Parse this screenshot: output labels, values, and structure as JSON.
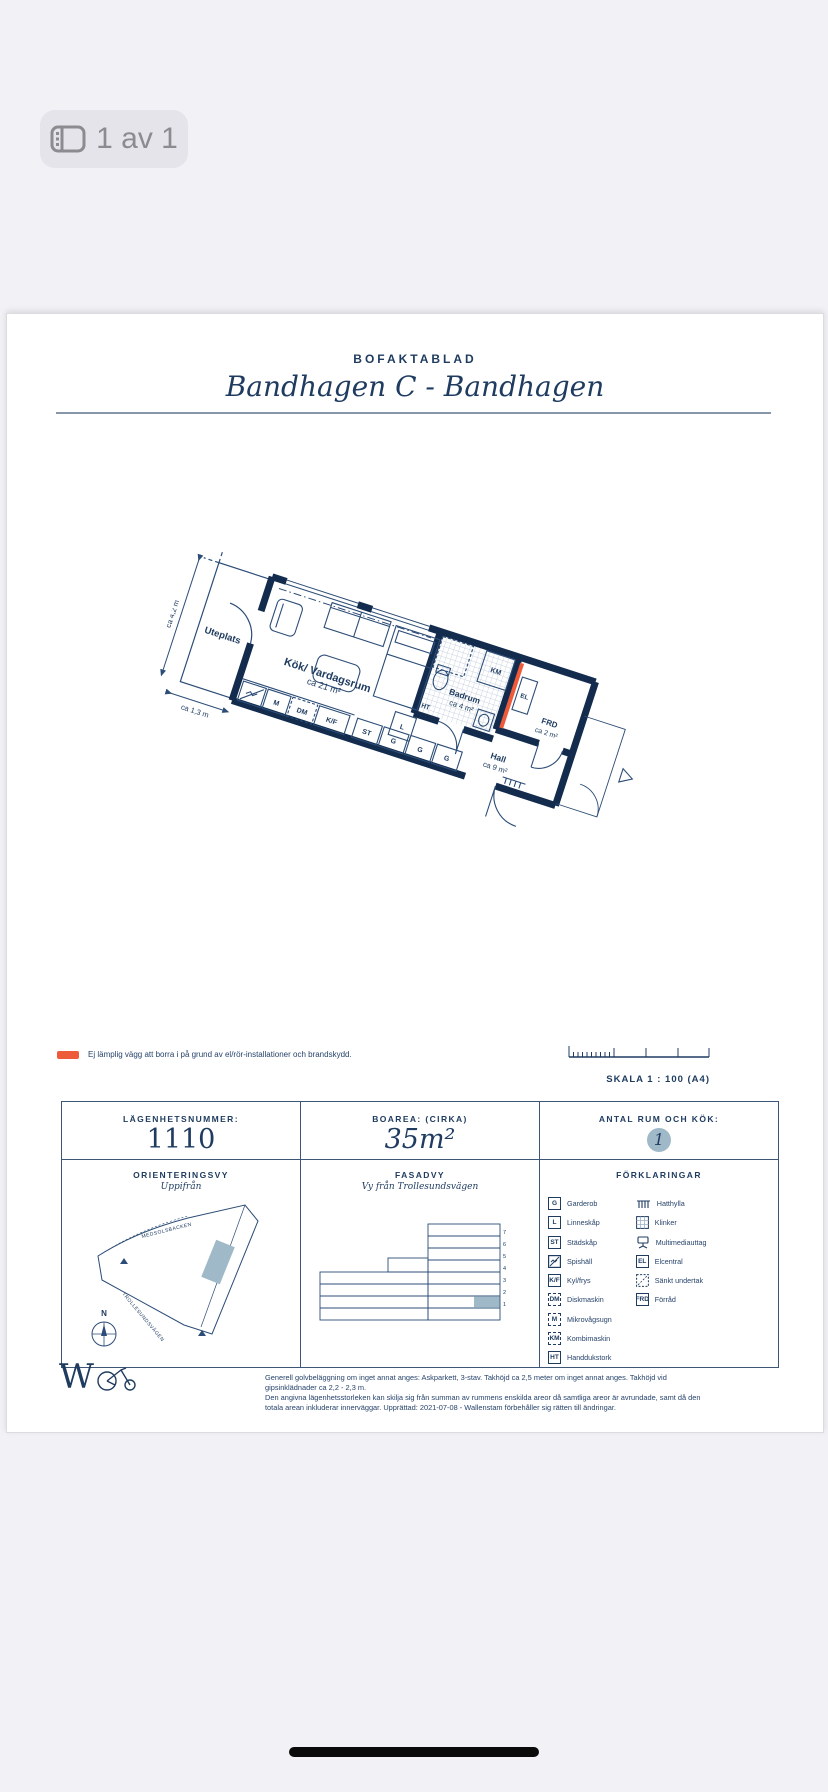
{
  "viewer": {
    "page_indicator": "1 av 1"
  },
  "header": {
    "eyebrow": "BOFAKTABLAD",
    "title": "Bandhagen C - Bandhagen"
  },
  "plan": {
    "rooms": {
      "uteplats": "Uteplats",
      "livingroom": {
        "name": "Kök/ Vardagsrum",
        "area": "ca 21 m²"
      },
      "badrum": {
        "name": "Badrum",
        "area": "ca 4 m²"
      },
      "hall": {
        "name": "Hall",
        "area": "ca 9 m²"
      },
      "frd": {
        "name": "FRD",
        "area": "ca 2 m²"
      }
    },
    "dimensions": {
      "left": "ca 4,2 m",
      "bottom": "ca 1,3 m"
    },
    "fixtures": {
      "m": "M",
      "dm": "DM",
      "kf": "K/F",
      "st": "ST",
      "g1": "G",
      "g2": "G",
      "g3": "G",
      "l": "L",
      "ht": "HT",
      "km": "KM",
      "el": "EL"
    },
    "colors": {
      "wall": "#132c4e",
      "line": "#2c4d77",
      "warning": "#ee5b3a"
    }
  },
  "note": {
    "text": "Ej lämplig vägg att borra i på grund av el/rör-installationer och brandskydd."
  },
  "scale": {
    "label": "SKALA 1 : 100 (A4)"
  },
  "info": {
    "apartment": {
      "label": "LÄGENHETSNUMMER:",
      "value": "1110"
    },
    "area": {
      "label": "BOAREA: (CIRKA)",
      "value": "35m²"
    },
    "rooms": {
      "label": "ANTAL RUM OCH KÖK:",
      "value": "1"
    },
    "orientation": {
      "label": "ORIENTERINGSVY",
      "sub": "Uppifrån",
      "street_top": "MEDSOLSBACKEN",
      "street_bottom": "TROLLESUNDSVÄGEN",
      "compass": "N"
    },
    "facade": {
      "label": "FASADVY",
      "sub": "Vy från Trollesundsvägen",
      "floors": [
        "7",
        "6",
        "5",
        "4",
        "3",
        "2",
        "1"
      ]
    },
    "legend": {
      "label": "FÖRKLARINGAR",
      "left": [
        {
          "key": "G",
          "label": "Garderob"
        },
        {
          "key": "L",
          "label": "Linneskåp"
        },
        {
          "key": "ST",
          "label": "Städskåp"
        },
        {
          "icon": "spishall",
          "label": "Spishäll"
        },
        {
          "key": "K/F",
          "label": "Kyl/frys"
        },
        {
          "key": "DM",
          "label": "Diskmaskin",
          "dashed": true
        },
        {
          "key": "M",
          "label": "Mikrovågsugn",
          "dashed": true
        },
        {
          "key": "KM",
          "label": "Kombimaskin",
          "dashed": true
        },
        {
          "key": "HT",
          "label": "Handdukstork"
        }
      ],
      "right": [
        {
          "icon": "hatthylla",
          "label": "Hatthylla"
        },
        {
          "icon": "klinker",
          "label": "Klinker"
        },
        {
          "icon": "multimedia",
          "label": "Multimediauttag"
        },
        {
          "key": "EL",
          "label": "Elcentral"
        },
        {
          "icon": "sankt-undertak",
          "label": "Sänkt undertak"
        },
        {
          "key": "FRD",
          "label": "Förråd"
        }
      ]
    }
  },
  "footer": {
    "line1": "Generell golvbeläggning om inget annat anges: Askparkett, 3-stav. Takhöjd ca 2,5 meter om inget annat anges. Takhöjd vid gipsinklädnader ca 2,2 - 2,3 m.",
    "line2": "Den angivna lägenhetsstorleken kan skilja sig från summan av rummens enskilda areor då samtliga areor är avrundade, samt då den totala arean inkluderar innerväggar. Upprättad: 2021-07-08 - Wallenstam förbehåller sig rätten till ändringar.",
    "logo": "W"
  }
}
